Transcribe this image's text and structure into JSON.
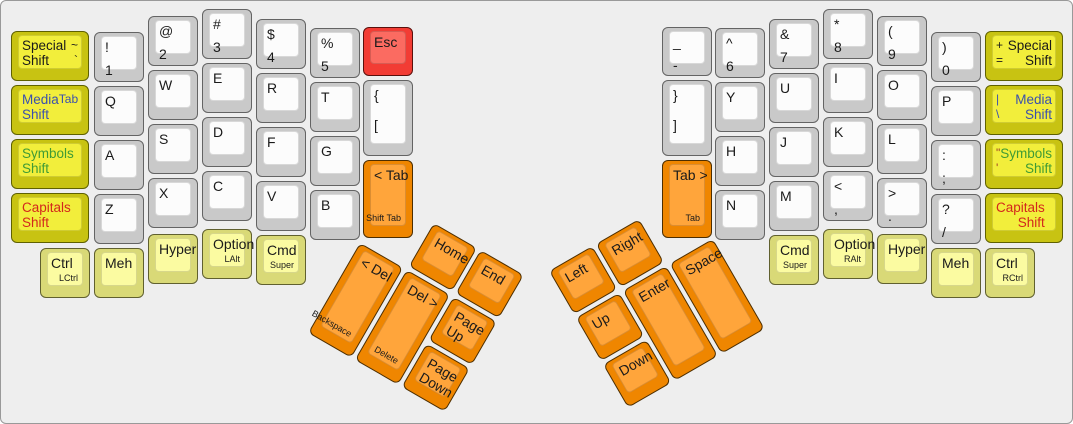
{
  "canvas": {
    "width": 1073,
    "height": 424,
    "background": "#eeeeee",
    "border": "#999999"
  },
  "palette": {
    "white_key_top": "#fcfcfc",
    "white_key_side": "#c9c9c9",
    "shift_key_top": "#f2ee3b",
    "shift_key_side": "#c8c312",
    "modifier_key_top": "#fbfba1",
    "modifier_key_side": "#d9d977",
    "orange_key_top": "#ffa53b",
    "orange_key_side": "#ef8600",
    "esc_key_top": "#fb6b61",
    "esc_key_side": "#f23c34",
    "text_default": "#1a1a1a",
    "text_blue": "#3a50ae",
    "text_green": "#3f9b35",
    "text_red": "#d3281c",
    "text_brown": "#a04028"
  },
  "keyboard": {
    "left_main": [
      {
        "n": "special-shift-left",
        "x": 10,
        "y": 30,
        "w": 78,
        "h": 50,
        "c": "shift",
        "l": [
          "Special",
          "Shift"
        ],
        "aux": [
          "~",
          "`"
        ]
      },
      {
        "n": "media-shift-left",
        "x": 10,
        "y": 84,
        "w": 78,
        "h": 50,
        "c": "shift",
        "l": [
          "Media",
          "Shift"
        ],
        "lc": "blue",
        "aux": [
          "Tab"
        ],
        "ac": "blue"
      },
      {
        "n": "symbols-shift-left",
        "x": 10,
        "y": 138,
        "w": 78,
        "h": 50,
        "c": "shift",
        "l": [
          "Symbols",
          "Shift"
        ],
        "lc": "green"
      },
      {
        "n": "capitals-shift-left",
        "x": 10,
        "y": 192,
        "w": 78,
        "h": 50,
        "c": "shift",
        "l": [
          "Capitals",
          "Shift"
        ],
        "lc": "red"
      },
      {
        "n": "1",
        "x": 93,
        "y": 31,
        "l": [
          "!",
          "1"
        ]
      },
      {
        "n": "q",
        "x": 93,
        "y": 85,
        "l": [
          "Q"
        ]
      },
      {
        "n": "a",
        "x": 93,
        "y": 139,
        "l": [
          "A"
        ]
      },
      {
        "n": "z",
        "x": 93,
        "y": 193,
        "l": [
          "Z"
        ]
      },
      {
        "n": "2",
        "x": 147,
        "y": 15,
        "l": [
          "@",
          "2"
        ]
      },
      {
        "n": "w",
        "x": 147,
        "y": 69,
        "l": [
          "W"
        ]
      },
      {
        "n": "s",
        "x": 147,
        "y": 123,
        "l": [
          "S"
        ]
      },
      {
        "n": "x",
        "x": 147,
        "y": 177,
        "l": [
          "X"
        ]
      },
      {
        "n": "3",
        "x": 201,
        "y": 8,
        "l": [
          "#",
          "3"
        ]
      },
      {
        "n": "e",
        "x": 201,
        "y": 62,
        "l": [
          "E"
        ]
      },
      {
        "n": "d",
        "x": 201,
        "y": 116,
        "l": [
          "D"
        ]
      },
      {
        "n": "c",
        "x": 201,
        "y": 170,
        "l": [
          "C"
        ]
      },
      {
        "n": "4",
        "x": 255,
        "y": 18,
        "l": [
          "$",
          "4"
        ]
      },
      {
        "n": "r",
        "x": 255,
        "y": 72,
        "l": [
          "R"
        ]
      },
      {
        "n": "f",
        "x": 255,
        "y": 126,
        "l": [
          "F"
        ]
      },
      {
        "n": "v",
        "x": 255,
        "y": 180,
        "l": [
          "V"
        ]
      },
      {
        "n": "5",
        "x": 309,
        "y": 27,
        "l": [
          "%",
          "5"
        ]
      },
      {
        "n": "t",
        "x": 309,
        "y": 81,
        "l": [
          "T"
        ]
      },
      {
        "n": "g",
        "x": 309,
        "y": 135,
        "l": [
          "G"
        ]
      },
      {
        "n": "b",
        "x": 309,
        "y": 189,
        "l": [
          "B"
        ]
      },
      {
        "n": "esc",
        "x": 362,
        "y": 26,
        "h": 49,
        "c": "red",
        "l": [
          "Esc"
        ]
      },
      {
        "n": "left-bracket",
        "x": 362,
        "y": 79,
        "h": 76,
        "l": [
          "{",
          "["
        ]
      },
      {
        "n": "shift-tab",
        "x": 362,
        "y": 159,
        "h": 78,
        "c": "orange",
        "l": [
          "< Tab"
        ],
        "sub": "Shift Tab"
      },
      {
        "n": "lctrl",
        "x": 39,
        "y": 247,
        "c": "mod",
        "l": [
          "Ctrl"
        ],
        "sub": "LCtrl"
      },
      {
        "n": "meh-left",
        "x": 93,
        "y": 247,
        "c": "mod",
        "l": [
          "Meh"
        ]
      },
      {
        "n": "hyper-left",
        "x": 147,
        "y": 233,
        "c": "mod",
        "l": [
          "Hyper"
        ]
      },
      {
        "n": "lalt",
        "x": 201,
        "y": 228,
        "c": "mod",
        "l": [
          "Option"
        ],
        "sub": "LAlt"
      },
      {
        "n": "cmd-left",
        "x": 255,
        "y": 234,
        "c": "mod",
        "l": [
          "Cmd"
        ],
        "sub": "Super"
      }
    ],
    "right_main": [
      {
        "n": "minus",
        "x": 661,
        "y": 26,
        "h": 49,
        "l": [
          "_",
          "-"
        ]
      },
      {
        "n": "right-bracket",
        "x": 661,
        "y": 79,
        "h": 76,
        "l": [
          "}",
          "]"
        ]
      },
      {
        "n": "tab",
        "x": 661,
        "y": 159,
        "h": 78,
        "c": "orange",
        "l": [
          "Tab >"
        ],
        "sub": "Tab"
      },
      {
        "n": "6",
        "x": 714,
        "y": 27,
        "l": [
          "^",
          "6"
        ]
      },
      {
        "n": "y",
        "x": 714,
        "y": 81,
        "l": [
          "Y"
        ]
      },
      {
        "n": "h",
        "x": 714,
        "y": 135,
        "l": [
          "H"
        ]
      },
      {
        "n": "n",
        "x": 714,
        "y": 189,
        "l": [
          "N"
        ]
      },
      {
        "n": "7",
        "x": 768,
        "y": 18,
        "l": [
          "&",
          "7"
        ]
      },
      {
        "n": "u",
        "x": 768,
        "y": 72,
        "l": [
          "U"
        ]
      },
      {
        "n": "j",
        "x": 768,
        "y": 126,
        "l": [
          "J"
        ]
      },
      {
        "n": "m",
        "x": 768,
        "y": 180,
        "l": [
          "M"
        ]
      },
      {
        "n": "8",
        "x": 822,
        "y": 8,
        "l": [
          "*",
          "8"
        ]
      },
      {
        "n": "i",
        "x": 822,
        "y": 62,
        "l": [
          "I"
        ]
      },
      {
        "n": "k",
        "x": 822,
        "y": 116,
        "l": [
          "K"
        ]
      },
      {
        "n": "comma",
        "x": 822,
        "y": 170,
        "l": [
          "<",
          ","
        ]
      },
      {
        "n": "9",
        "x": 876,
        "y": 15,
        "l": [
          "(",
          "9"
        ]
      },
      {
        "n": "o",
        "x": 876,
        "y": 69,
        "l": [
          "O"
        ]
      },
      {
        "n": "l",
        "x": 876,
        "y": 123,
        "l": [
          "L"
        ]
      },
      {
        "n": "period",
        "x": 876,
        "y": 177,
        "l": [
          ">",
          "."
        ]
      },
      {
        "n": "0",
        "x": 930,
        "y": 31,
        "l": [
          ")",
          "0"
        ]
      },
      {
        "n": "p",
        "x": 930,
        "y": 85,
        "l": [
          "P"
        ]
      },
      {
        "n": "semicolon",
        "x": 930,
        "y": 139,
        "l": [
          ":",
          ";"
        ]
      },
      {
        "n": "slash",
        "x": 930,
        "y": 193,
        "l": [
          "?",
          "/"
        ]
      },
      {
        "n": "special-shift-right",
        "x": 984,
        "y": 30,
        "w": 78,
        "c": "shift",
        "l": [
          "Special",
          "Shift"
        ],
        "aux": [
          "+",
          "="
        ],
        "mirror": true
      },
      {
        "n": "media-shift-right",
        "x": 984,
        "y": 84,
        "w": 78,
        "c": "shift",
        "l": [
          "Media",
          "Shift"
        ],
        "lc": "blue",
        "aux": [
          "|",
          "\\"
        ],
        "ac": "blue",
        "mirror": true
      },
      {
        "n": "symbols-shift-right",
        "x": 984,
        "y": 138,
        "w": 78,
        "c": "shift",
        "l": [
          "Symbols",
          "Shift"
        ],
        "lc": "green",
        "aux": [
          "\"",
          "'"
        ],
        "ac": "brown",
        "mirror": true
      },
      {
        "n": "capitals-shift-right",
        "x": 984,
        "y": 192,
        "w": 78,
        "c": "shift",
        "l": [
          "Capitals",
          "Shift"
        ],
        "lc": "red",
        "mirror": true
      },
      {
        "n": "cmd-right",
        "x": 768,
        "y": 234,
        "c": "mod",
        "l": [
          "Cmd"
        ],
        "sub": "Super"
      },
      {
        "n": "ralt",
        "x": 822,
        "y": 228,
        "c": "mod",
        "l": [
          "Option"
        ],
        "sub": "RAlt"
      },
      {
        "n": "hyper-right",
        "x": 876,
        "y": 233,
        "c": "mod",
        "l": [
          "Hyper"
        ]
      },
      {
        "n": "meh-right",
        "x": 930,
        "y": 247,
        "c": "mod",
        "l": [
          "Meh"
        ]
      },
      {
        "n": "rctrl",
        "x": 984,
        "y": 247,
        "c": "mod",
        "l": [
          "Ctrl"
        ],
        "sub": "RCtrl"
      }
    ],
    "left_thumb": {
      "origin": {
        "x": 386,
        "y": 195
      },
      "rotation": 30,
      "keys": [
        {
          "n": "home",
          "x": 54,
          "y": 0,
          "c": "orange",
          "l": [
            "Home"
          ]
        },
        {
          "n": "end",
          "x": 108,
          "y": 0,
          "c": "orange",
          "l": [
            "End"
          ]
        },
        {
          "n": "backspace",
          "x": 0,
          "y": 54,
          "h": 104,
          "c": "orange",
          "l": [
            "< Del"
          ],
          "sub": "Backspace"
        },
        {
          "n": "delete",
          "x": 54,
          "y": 54,
          "h": 104,
          "c": "orange",
          "l": [
            "Del >"
          ],
          "sub": "Delete"
        },
        {
          "n": "page-up",
          "x": 108,
          "y": 54,
          "c": "orange",
          "l": [
            "Page",
            "Up"
          ]
        },
        {
          "n": "page-down",
          "x": 108,
          "y": 108,
          "c": "orange",
          "l": [
            "Page",
            "Down"
          ]
        }
      ]
    },
    "right_thumb": {
      "origin": {
        "x": 548,
        "y": 270
      },
      "rotation": -30,
      "keys": [
        {
          "n": "left",
          "x": 0,
          "y": 0,
          "c": "orange",
          "l": [
            "Left"
          ]
        },
        {
          "n": "right",
          "x": 54,
          "y": 0,
          "c": "orange",
          "l": [
            "Right"
          ]
        },
        {
          "n": "up",
          "x": 0,
          "y": 54,
          "c": "orange",
          "l": [
            "Up"
          ]
        },
        {
          "n": "enter",
          "x": 54,
          "y": 54,
          "h": 104,
          "c": "orange",
          "l": [
            "Enter"
          ]
        },
        {
          "n": "space",
          "x": 108,
          "y": 54,
          "h": 104,
          "c": "orange",
          "l": [
            "Space"
          ]
        },
        {
          "n": "down",
          "x": 0,
          "y": 108,
          "c": "orange",
          "l": [
            "Down"
          ]
        }
      ]
    }
  }
}
